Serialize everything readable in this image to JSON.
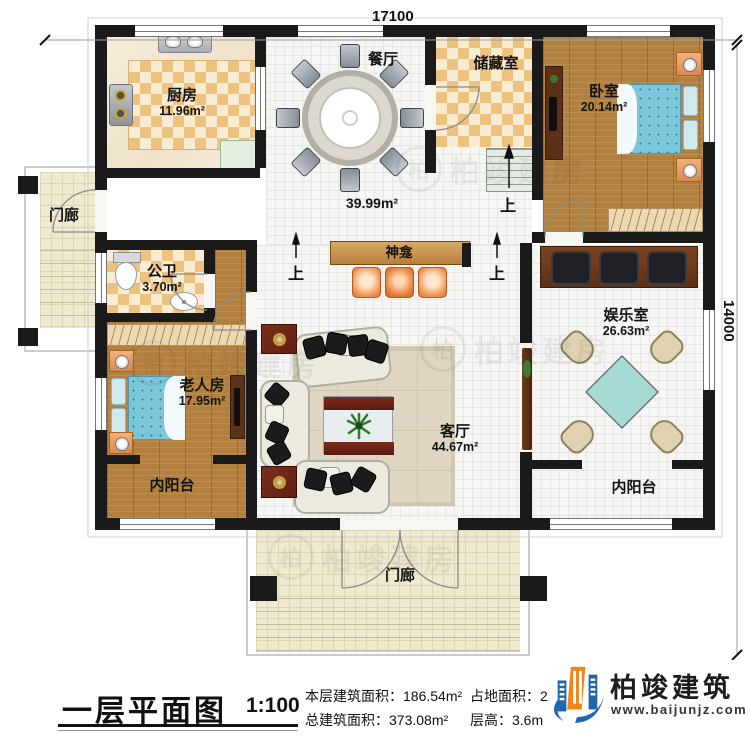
{
  "dim": {
    "w": "17100",
    "h": "14000"
  },
  "rooms": {
    "kitchen": {
      "name": "厨房",
      "area": "11.96m²"
    },
    "dining": {
      "name": "餐厅"
    },
    "hall": {
      "area": "39.99m²"
    },
    "storage": {
      "name": "储藏室"
    },
    "bedroom": {
      "name": "卧室",
      "area": "20.14m²"
    },
    "porch_left": {
      "name": "门廊"
    },
    "bathroom": {
      "name": "公卫",
      "area": "3.70m²"
    },
    "elder": {
      "name": "老人房",
      "area": "17.95m²"
    },
    "balcony_left": {
      "name": "内阳台"
    },
    "shrine": {
      "name": "神龛"
    },
    "living": {
      "name": "客厅",
      "area": "44.67m²"
    },
    "entertainment": {
      "name": "娱乐室",
      "area": "26.63m²"
    },
    "balcony_right": {
      "name": "内阳台"
    },
    "porch_bottom": {
      "name": "门廊"
    }
  },
  "stairs": {
    "up": "上"
  },
  "footer": {
    "title": "一层平面图",
    "scale": "1:100",
    "stats": {
      "s1": {
        "label": "本层建筑面积：",
        "value": "186.54m²"
      },
      "s2": {
        "label": "占地面积：",
        "value": "200.8㎡"
      },
      "s3": {
        "label": "总建筑面积：",
        "value": "373.08m²"
      },
      "s4": {
        "label": "层高：",
        "value": "3.6m"
      }
    },
    "brand": {
      "name": "柏竣建筑",
      "url": "www.baijunjz.com"
    }
  },
  "watermark": {
    "text": "柏竣建房",
    "initial": "柏"
  }
}
